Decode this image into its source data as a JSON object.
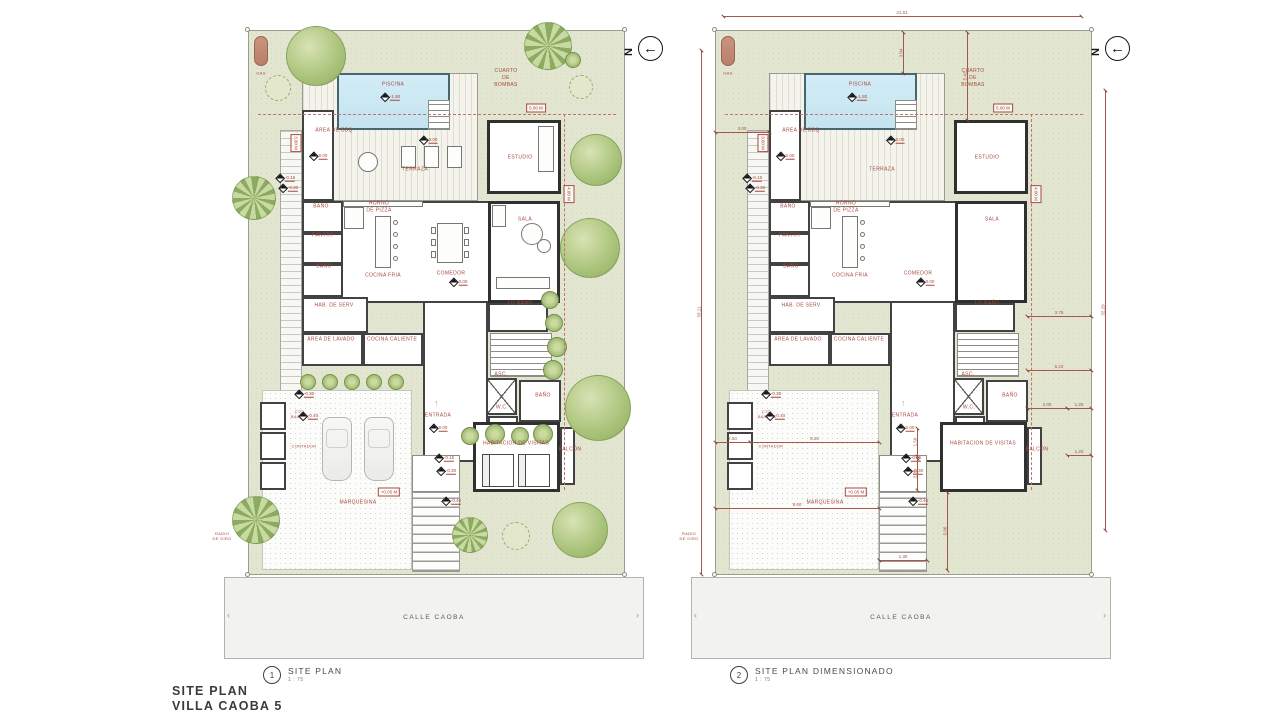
{
  "meta": {
    "title_line1": "SITE PLAN",
    "title_line2": "VILLA CAOBA 5"
  },
  "street_label": "CALLE CAOBA",
  "north_letter": "N",
  "colors": {
    "accent_red": "#a6493e",
    "lot_green": "#e2e5d0",
    "pool_blue": "#cde9f3",
    "wall_dark": "#424242",
    "street_gray": "#f2f2ef"
  },
  "plans": [
    {
      "number": "1",
      "caption": "SITE PLAN",
      "scale": "1 : 75",
      "lot_x": 248,
      "dimensioned": false
    },
    {
      "number": "2",
      "caption": "SITE PLAN DIMENSIONADO",
      "scale": "1 : 75",
      "lot_x": 715,
      "dimensioned": true
    }
  ],
  "lot": {
    "y": 30,
    "w": 377,
    "h": 545
  },
  "street": {
    "dx": -24,
    "y": 547,
    "w": 420,
    "h": 82
  },
  "marker": {
    "cx": 15,
    "cy": 636,
    "d": 18
  },
  "structures": [
    {
      "name": "terraza-deck",
      "cls": "stripesV",
      "x": 54,
      "y": 43,
      "w": 176,
      "h": 128
    },
    {
      "name": "piscina-pool",
      "cls": "pool",
      "x": 89,
      "y": 43,
      "w": 113,
      "h": 57
    },
    {
      "name": "pool-steps",
      "cls": "stairs",
      "x": 180,
      "y": 70,
      "w": 22,
      "h": 30
    },
    {
      "name": "area-bbq-room",
      "cls": "room",
      "x": 54,
      "y": 80,
      "w": 32,
      "h": 91
    },
    {
      "name": "estudio-room",
      "cls": "thick",
      "x": 239,
      "y": 90,
      "w": 74,
      "h": 74
    },
    {
      "name": "main-body",
      "cls": "room",
      "x": 54,
      "y": 171,
      "w": 258,
      "h": 102
    },
    {
      "name": "sala-room",
      "cls": "thick",
      "x": 240,
      "y": 171,
      "w": 72,
      "h": 102
    },
    {
      "name": "bano-1-room",
      "cls": "room",
      "x": 54,
      "y": 171,
      "w": 41,
      "h": 32
    },
    {
      "name": "pantry-room",
      "cls": "room",
      "x": 54,
      "y": 203,
      "w": 41,
      "h": 31
    },
    {
      "name": "bano-2-room",
      "cls": "room",
      "x": 54,
      "y": 234,
      "w": 41,
      "h": 33
    },
    {
      "name": "hab-serv-room",
      "cls": "room",
      "x": 54,
      "y": 267,
      "w": 66,
      "h": 36
    },
    {
      "name": "area-lavado-room",
      "cls": "room",
      "x": 54,
      "y": 303,
      "w": 61,
      "h": 33
    },
    {
      "name": "cocina-caliente-room",
      "cls": "room",
      "x": 115,
      "y": 303,
      "w": 60,
      "h": 33
    },
    {
      "name": "entrada-hall",
      "cls": "room",
      "x": 175,
      "y": 271,
      "w": 65,
      "h": 161
    },
    {
      "name": "half-bano-room",
      "cls": "room",
      "x": 240,
      "y": 273,
      "w": 60,
      "h": 29
    },
    {
      "name": "interior-stairs",
      "cls": "stairs",
      "x": 242,
      "y": 303,
      "w": 62,
      "h": 44
    },
    {
      "name": "ascensor",
      "cls": "asc",
      "x": 238,
      "y": 348,
      "w": 31,
      "h": 37
    },
    {
      "name": "bano-3-room",
      "cls": "room",
      "x": 271,
      "y": 350,
      "w": 42,
      "h": 42
    },
    {
      "name": "wc-room",
      "cls": "room",
      "x": 240,
      "y": 386,
      "w": 30,
      "h": 30
    },
    {
      "name": "habitacion-visitas-room",
      "cls": "thick",
      "x": 225,
      "y": 392,
      "w": 87,
      "h": 70
    },
    {
      "name": "balcon-room",
      "cls": "room",
      "x": 312,
      "y": 397,
      "w": 15,
      "h": 58
    },
    {
      "name": "side-path",
      "cls": "stripesH",
      "x": 32,
      "y": 100,
      "w": 22,
      "h": 262
    },
    {
      "name": "marquesina-paving",
      "cls": "paving",
      "x": 14,
      "y": 360,
      "w": 150,
      "h": 180
    },
    {
      "name": "utility-box-1",
      "cls": "room",
      "x": 12,
      "y": 372,
      "w": 26,
      "h": 28
    },
    {
      "name": "utility-box-2",
      "cls": "room",
      "x": 12,
      "y": 402,
      "w": 26,
      "h": 28
    },
    {
      "name": "utility-box-3",
      "cls": "room",
      "x": 12,
      "y": 432,
      "w": 26,
      "h": 28
    },
    {
      "name": "entry-landing",
      "cls": "thin",
      "x": 164,
      "y": 425,
      "w": 48,
      "h": 37
    },
    {
      "name": "entry-walkway",
      "cls": "stairsBig",
      "x": 164,
      "y": 462,
      "w": 48,
      "h": 80
    },
    {
      "name": "gas-tank",
      "cls": "gas-tank",
      "x": 6,
      "y": 6,
      "w": 14,
      "h": 30
    }
  ],
  "fixtures": [
    {
      "name": "kitchen-counter",
      "kind": "rect",
      "cls": "furn",
      "x": 95,
      "y": 171,
      "w": 80,
      "h": 6
    },
    {
      "name": "pizza-oven",
      "kind": "rect",
      "cls": "furn",
      "x": 96,
      "y": 177,
      "w": 20,
      "h": 22
    },
    {
      "name": "kitchen-island",
      "kind": "rect",
      "cls": "furn",
      "x": 127,
      "y": 186,
      "w": 16,
      "h": 52
    },
    {
      "name": "island-stool",
      "kind": "circle",
      "cls": "furn-round",
      "x": 147,
      "y": 192,
      "r": 2.5
    },
    {
      "name": "island-stool",
      "kind": "circle",
      "cls": "furn-round",
      "x": 147,
      "y": 204,
      "r": 2.5
    },
    {
      "name": "island-stool",
      "kind": "circle",
      "cls": "furn-round",
      "x": 147,
      "y": 216,
      "r": 2.5
    },
    {
      "name": "island-stool",
      "kind": "circle",
      "cls": "furn-round",
      "x": 147,
      "y": 228,
      "r": 2.5
    }
  ],
  "furniture": [
    {
      "name": "deck-lounger",
      "kind": "rect",
      "cls": "furn",
      "x": 153,
      "y": 116,
      "w": 15,
      "h": 22
    },
    {
      "name": "deck-lounger",
      "kind": "rect",
      "cls": "furn",
      "x": 176,
      "y": 116,
      "w": 15,
      "h": 22
    },
    {
      "name": "deck-lounger",
      "kind": "rect",
      "cls": "furn",
      "x": 199,
      "y": 116,
      "w": 15,
      "h": 22
    },
    {
      "name": "deck-table",
      "kind": "circle",
      "cls": "furn-round",
      "x": 120,
      "y": 132,
      "r": 10
    },
    {
      "name": "dining-table",
      "kind": "rect",
      "cls": "furn",
      "x": 189,
      "y": 193,
      "w": 26,
      "h": 40
    },
    {
      "name": "dining-chair",
      "kind": "rect",
      "cls": "furn",
      "x": 183,
      "y": 197,
      "w": 5,
      "h": 7
    },
    {
      "name": "dining-chair",
      "kind": "rect",
      "cls": "furn",
      "x": 183,
      "y": 209,
      "w": 5,
      "h": 7
    },
    {
      "name": "dining-chair",
      "kind": "rect",
      "cls": "furn",
      "x": 183,
      "y": 221,
      "w": 5,
      "h": 7
    },
    {
      "name": "dining-chair",
      "kind": "rect",
      "cls": "furn",
      "x": 216,
      "y": 197,
      "w": 5,
      "h": 7
    },
    {
      "name": "dining-chair",
      "kind": "rect",
      "cls": "furn",
      "x": 216,
      "y": 209,
      "w": 5,
      "h": 7
    },
    {
      "name": "dining-chair",
      "kind": "rect",
      "cls": "furn",
      "x": 216,
      "y": 221,
      "w": 5,
      "h": 7
    },
    {
      "name": "sala-sofa",
      "kind": "rect",
      "cls": "furn",
      "x": 248,
      "y": 247,
      "w": 54,
      "h": 12
    },
    {
      "name": "sala-armchair",
      "kind": "rect",
      "cls": "furn",
      "x": 244,
      "y": 175,
      "w": 14,
      "h": 22
    },
    {
      "name": "sala-lounge",
      "kind": "circle",
      "cls": "furn-round",
      "x": 284,
      "y": 204,
      "r": 11
    },
    {
      "name": "sala-lounge",
      "kind": "circle",
      "cls": "furn-round",
      "x": 296,
      "y": 216,
      "r": 7
    },
    {
      "name": "estudio-sofa",
      "kind": "rect",
      "cls": "furn",
      "x": 290,
      "y": 96,
      "w": 16,
      "h": 46
    },
    {
      "name": "guest-bed",
      "kind": "rect",
      "cls": "bed",
      "x": 234,
      "y": 424,
      "w": 32,
      "h": 33
    },
    {
      "name": "guest-bed",
      "kind": "rect",
      "cls": "bed",
      "x": 270,
      "y": 424,
      "w": 32,
      "h": 33
    }
  ],
  "cars": [
    {
      "x": 74,
      "y": 387,
      "w": 30,
      "h": 64
    },
    {
      "x": 116,
      "y": 387,
      "w": 30,
      "h": 64
    }
  ],
  "room_labels": [
    {
      "text": "PISCINA",
      "x": 145,
      "y": 55
    },
    {
      "text": "CUARTO\nDE\nBOMBAS",
      "x": 258,
      "y": 48
    },
    {
      "text": "ÁREA DE BBQ",
      "x": 86,
      "y": 101
    },
    {
      "text": "TERRAZA",
      "x": 167,
      "y": 140
    },
    {
      "text": "ESTUDIO",
      "x": 272,
      "y": 128
    },
    {
      "text": "BAÑO",
      "x": 73,
      "y": 177
    },
    {
      "text": "HORNO\nDE PIZZA",
      "x": 131,
      "y": 177
    },
    {
      "text": "PANTRY",
      "x": 75,
      "y": 206
    },
    {
      "text": "BAÑO",
      "x": 76,
      "y": 237
    },
    {
      "text": "COCINA FRIA",
      "x": 135,
      "y": 246
    },
    {
      "text": "COMEDOR",
      "x": 203,
      "y": 244
    },
    {
      "text": "SALA",
      "x": 277,
      "y": 190
    },
    {
      "text": "HAB. DE SERV",
      "x": 86,
      "y": 276
    },
    {
      "text": "ÁREA DE LAVADO",
      "x": 83,
      "y": 310
    },
    {
      "text": "COCINA CALIENTE",
      "x": 144,
      "y": 310
    },
    {
      "text": "1/2 BAÑO",
      "x": 272,
      "y": 274
    },
    {
      "text": "ASC.",
      "x": 253,
      "y": 345
    },
    {
      "text": "BAÑO",
      "x": 295,
      "y": 366
    },
    {
      "text": "W.C.",
      "x": 254,
      "y": 378
    },
    {
      "text": "ENTRADA",
      "x": 190,
      "y": 386
    },
    {
      "text": "HABITACION DE VISITAS",
      "x": 268,
      "y": 414
    },
    {
      "text": "BALCÓN",
      "x": 322,
      "y": 420
    },
    {
      "text": "MARQUESINA",
      "x": 110,
      "y": 473
    }
  ],
  "annotations": [
    {
      "text": "GAS",
      "x": 13,
      "y": 43
    },
    {
      "text": "CTO.\nBASURA",
      "x": 52,
      "y": 384
    },
    {
      "text": "CONTADOR",
      "x": 56,
      "y": 416
    },
    {
      "text": "RADIO\nDE GIRO",
      "x": -26,
      "y": 506
    }
  ],
  "elevations": [
    {
      "text": "-1.80",
      "x": 143,
      "y": 67
    },
    {
      "text": "0.00",
      "x": 181,
      "y": 110
    },
    {
      "text": "0.00",
      "x": 71,
      "y": 126
    },
    {
      "text": "-0.15",
      "x": 38,
      "y": 148
    },
    {
      "text": "-0.30",
      "x": 41,
      "y": 158
    },
    {
      "text": "0.00",
      "x": 211,
      "y": 252
    },
    {
      "text": "0.00",
      "x": 191,
      "y": 398
    },
    {
      "text": "-0.15",
      "x": 197,
      "y": 428
    },
    {
      "text": "-0.30",
      "x": 199,
      "y": 441
    },
    {
      "text": "-0.40",
      "x": 204,
      "y": 471
    },
    {
      "text": "-0.30",
      "x": 57,
      "y": 364
    },
    {
      "text": "-0.40",
      "x": 61,
      "y": 386
    }
  ],
  "setback_boxes": [
    {
      "text": "5.00 M",
      "x": 288,
      "y": 78,
      "vert": false
    },
    {
      "text": "4.00 M",
      "x": 321,
      "y": 164,
      "vert": true
    },
    {
      "text": "3.00 M",
      "x": 48,
      "y": 113,
      "vert": true
    },
    {
      "text": "+0.05 M",
      "x": 141,
      "y": 462,
      "vert": false
    }
  ],
  "dashed_lines": [
    {
      "x": 10,
      "y": 84,
      "len": 358,
      "vert": false
    },
    {
      "x": 316,
      "y": 84,
      "len": 376,
      "vert": true
    }
  ],
  "dims": [
    {
      "label": "21.61",
      "x": 8,
      "y": -14,
      "len": 358,
      "vert": false
    },
    {
      "label": "33.11",
      "x": -14,
      "y": 20,
      "len": 524,
      "vert": true
    },
    {
      "label": "32.29",
      "x": 390,
      "y": 60,
      "len": 440,
      "vert": true
    },
    {
      "label": "3.04",
      "x": 188,
      "y": 2,
      "len": 41,
      "vert": true
    },
    {
      "label": "5.42",
      "x": 252,
      "y": 2,
      "len": 88,
      "vert": true
    },
    {
      "label": "3.00",
      "x": 0,
      "y": 102,
      "len": 54,
      "vert": false
    },
    {
      "label": "3.78",
      "x": 312,
      "y": 286,
      "len": 64,
      "vert": false
    },
    {
      "label": "5.23",
      "x": 312,
      "y": 340,
      "len": 64,
      "vert": false
    },
    {
      "label": "2.00",
      "x": 312,
      "y": 378,
      "len": 40,
      "vert": false
    },
    {
      "label": "1.25",
      "x": 352,
      "y": 378,
      "len": 24,
      "vert": false
    },
    {
      "label": "1.25",
      "x": 352,
      "y": 425,
      "len": 24,
      "vert": false
    },
    {
      "label": "2.50",
      "x": 0,
      "y": 412,
      "len": 35,
      "vert": false
    },
    {
      "label": "8.20",
      "x": 35,
      "y": 412,
      "len": 129,
      "vert": false
    },
    {
      "label": "8.60",
      "x": 0,
      "y": 478,
      "len": 164,
      "vert": false
    },
    {
      "label": "5.06",
      "x": 232,
      "y": 462,
      "len": 78,
      "vert": true
    },
    {
      "label": "1.50",
      "x": 202,
      "y": 398,
      "len": 28,
      "vert": true
    },
    {
      "label": "3.00",
      "x": 202,
      "y": 428,
      "len": 32,
      "vert": true
    },
    {
      "label": "1.30",
      "x": 164,
      "y": 530,
      "len": 48,
      "vert": false
    }
  ],
  "trees": [
    {
      "kind": "canopy",
      "x": 68,
      "y": 26,
      "r": 30
    },
    {
      "kind": "bush",
      "x": 30,
      "y": 58,
      "r": 13
    },
    {
      "kind": "palm",
      "x": 300,
      "y": 16,
      "r": 24
    },
    {
      "kind": "ring",
      "x": 325,
      "y": 30,
      "r": 8
    },
    {
      "kind": "bush",
      "x": 333,
      "y": 57,
      "r": 12
    },
    {
      "kind": "palm",
      "x": 6,
      "y": 168,
      "r": 22
    },
    {
      "kind": "canopy",
      "x": 348,
      "y": 130,
      "r": 26
    },
    {
      "kind": "canopy",
      "x": 342,
      "y": 218,
      "r": 30
    },
    {
      "kind": "ring",
      "x": 302,
      "y": 270,
      "r": 9
    },
    {
      "kind": "ring",
      "x": 306,
      "y": 293,
      "r": 9
    },
    {
      "kind": "ring",
      "x": 309,
      "y": 317,
      "r": 10
    },
    {
      "kind": "ring",
      "x": 305,
      "y": 340,
      "r": 10
    },
    {
      "kind": "canopy",
      "x": 350,
      "y": 378,
      "r": 33
    },
    {
      "kind": "canopy",
      "x": 332,
      "y": 500,
      "r": 28
    },
    {
      "kind": "palm",
      "x": 8,
      "y": 490,
      "r": 24
    },
    {
      "kind": "bush",
      "x": 268,
      "y": 506,
      "r": 14
    },
    {
      "kind": "palm",
      "x": 222,
      "y": 505,
      "r": 18
    },
    {
      "kind": "ring",
      "x": 60,
      "y": 352,
      "r": 8
    },
    {
      "kind": "ring",
      "x": 82,
      "y": 352,
      "r": 8
    },
    {
      "kind": "ring",
      "x": 104,
      "y": 352,
      "r": 8
    },
    {
      "kind": "ring",
      "x": 126,
      "y": 352,
      "r": 8
    },
    {
      "kind": "ring",
      "x": 148,
      "y": 352,
      "r": 8
    },
    {
      "kind": "ring",
      "x": 222,
      "y": 406,
      "r": 9
    },
    {
      "kind": "ring",
      "x": 247,
      "y": 404,
      "r": 10
    },
    {
      "kind": "ring",
      "x": 272,
      "y": 406,
      "r": 9
    },
    {
      "kind": "ring",
      "x": 295,
      "y": 404,
      "r": 10
    }
  ]
}
